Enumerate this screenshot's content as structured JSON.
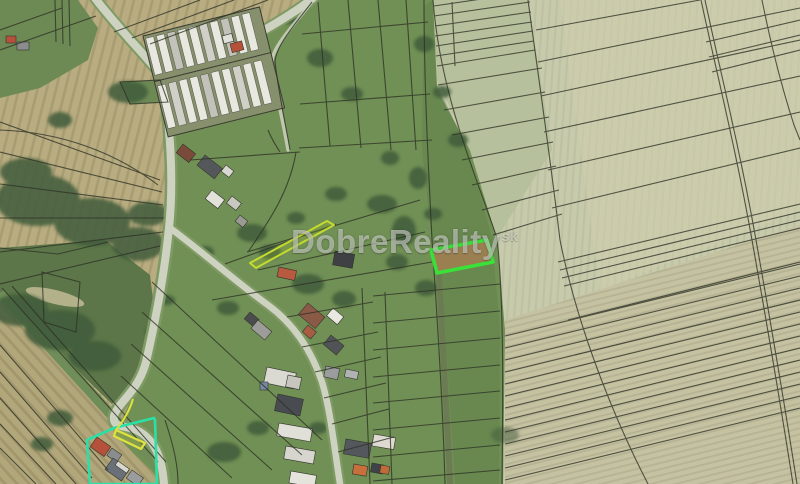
{
  "window": {
    "width_px": 800,
    "height_px": 484
  },
  "map": {
    "kind": "satellite-aerial-imagery-with-cadastral-parcels",
    "watermark": {
      "text": "DobreReality",
      "suffix": "sk"
    },
    "overlays": {
      "highlighted_parcel": {
        "role": "featured listed parcel",
        "stroke": "#38e638",
        "fill": "#9e7f52"
      },
      "teal_parcel": {
        "role": "outlined parcel bottom-left",
        "stroke": "#2be0a6"
      },
      "yellow_parcel": {
        "role": "small outlined parcel bottom-left",
        "stroke": "#dfe23e"
      },
      "sliver_parcel": {
        "role": "narrow outlined strip parcel center",
        "stroke": "#c3da2f"
      }
    },
    "palette": {
      "field_pale": "#c8cbab",
      "field_tan": "#b6ab80",
      "meadow_green": "#719055",
      "tree_green": "#3f5c3a",
      "road": "#ced2c1",
      "cadastral_line": "#2e3126"
    }
  }
}
